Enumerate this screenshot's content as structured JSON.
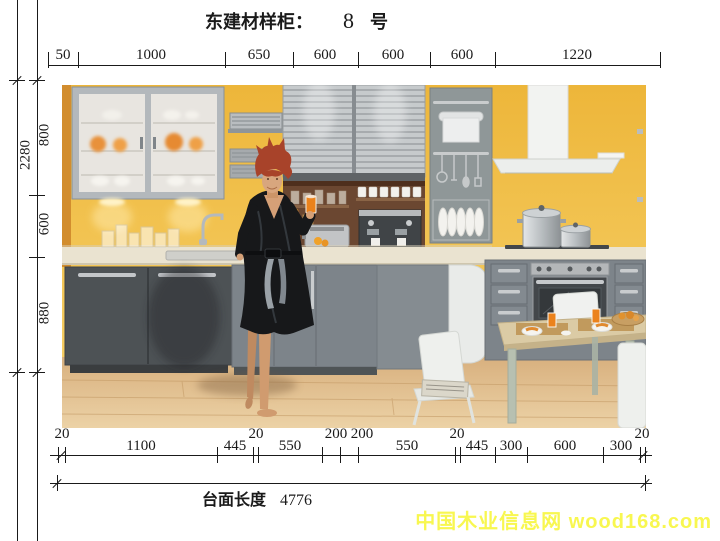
{
  "title": {
    "prefix": "东建材样柜：",
    "number": "8",
    "suffix": "号"
  },
  "dimensions": {
    "top_row": [
      "50",
      "1000",
      "650",
      "600",
      "600",
      "600",
      "1220"
    ],
    "left_total": "2280",
    "left_row": [
      "800",
      "600",
      "880"
    ],
    "bottom_small": [
      "20",
      "20",
      "200",
      "200",
      "20",
      "20"
    ],
    "bottom_row": [
      "1100",
      "445",
      "550",
      "550",
      "445",
      "300",
      "600",
      "300"
    ],
    "overall_label": "台面长度",
    "overall_value": "4776"
  },
  "watermark": {
    "text": "中国木业信息网 wood168.com"
  },
  "colors": {
    "dimension_line": "#1a1a1a",
    "watermark": "#f8f750",
    "wall_yellow": "#f0bb42",
    "cabinet_gray": "#7d848a",
    "cabinet_dark": "#4d5255",
    "counter_cream": "#eae3d0",
    "floor_wood": "#dcb685",
    "robe_black": "#17181a",
    "hair_red": "#a8432a",
    "juice_orange": "#eb821c"
  }
}
